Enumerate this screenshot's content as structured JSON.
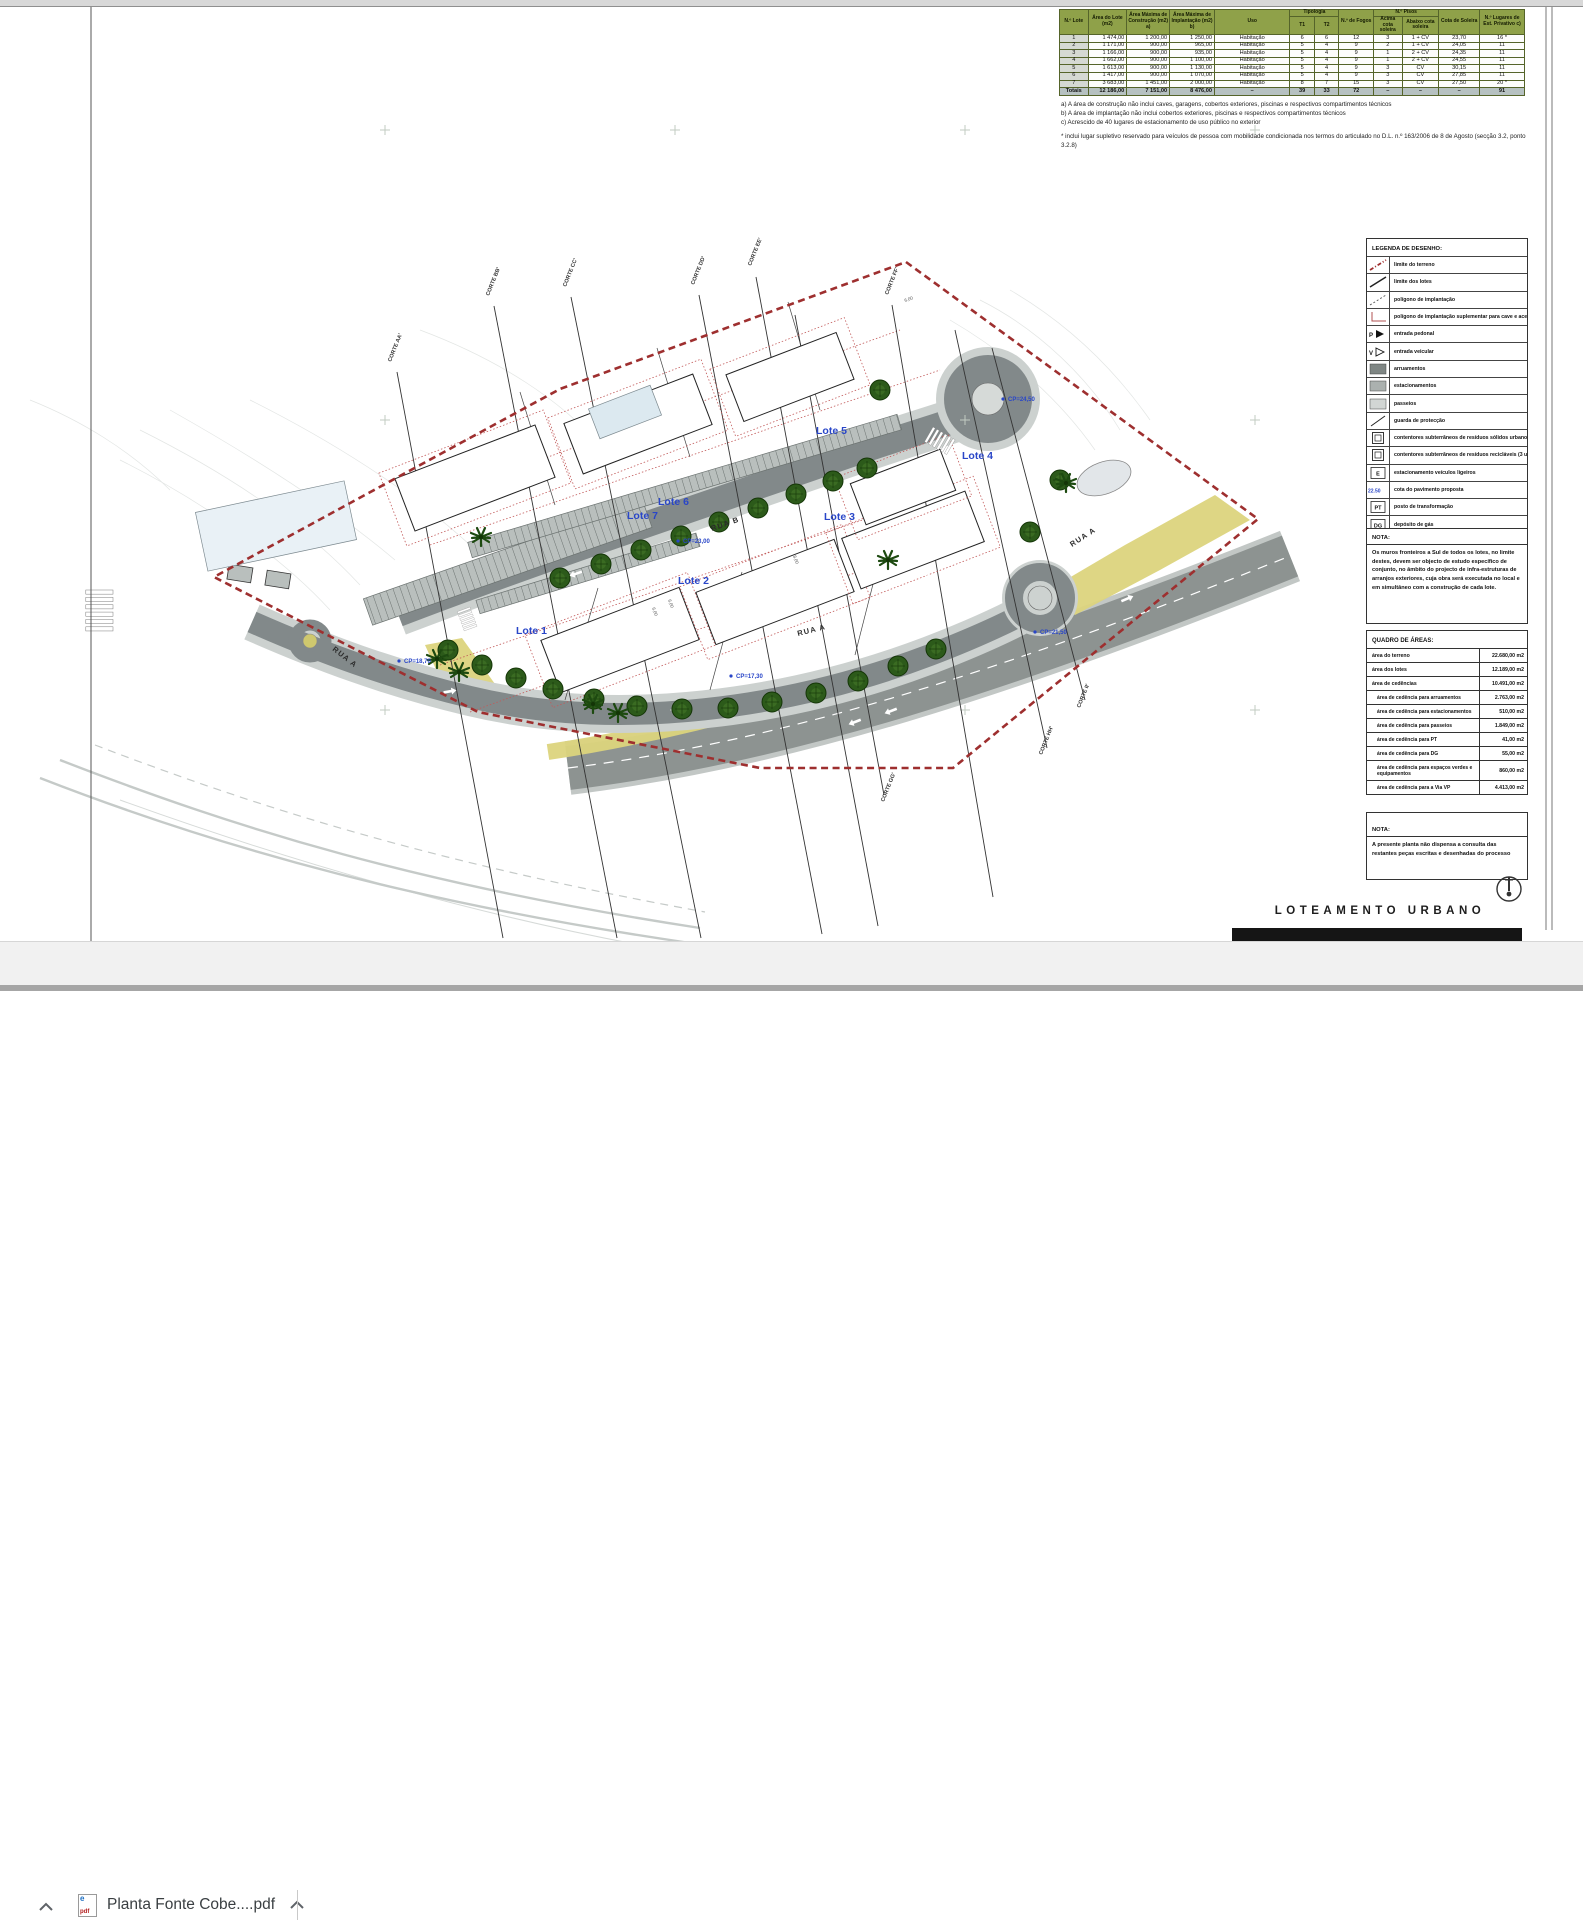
{
  "browser": {
    "download_bar": {
      "file_name": "Planta Fonte Cobe....pdf",
      "file_type": "pdf",
      "file_icon_letter": "e",
      "icons": {
        "hide_bar": "chevron-up",
        "file_menu": "chevron-up"
      }
    }
  },
  "sheet": {
    "table": {
      "headers": {
        "lote": "N.º Lote",
        "area_lote": "Área do Lote (m2)",
        "area_construcao": "Área Máxima de Construção (m2) a)",
        "area_implantacao": "Área Máxima de Implantação (m2) b)",
        "uso": "Uso",
        "tipologia": "Tipologia",
        "t1": "T1",
        "t2": "T2",
        "fogos": "N.º de Fogos",
        "pisos": "N.º Pisos",
        "acima": "Acima cota soleira",
        "abaixo": "Abaixo cota soleira",
        "cota": "Cota de Soleira",
        "lugares": "N.º Lugares de Est. Privativo c)"
      },
      "rows": [
        [
          "1",
          "1 474,00",
          "1 200,00",
          "1 250,00",
          "Habitação",
          "6",
          "6",
          "12",
          "3",
          "1 + CV",
          "23,70",
          "16 *"
        ],
        [
          "2",
          "1 171,00",
          "900,00",
          "965,00",
          "Habitação",
          "5",
          "4",
          "9",
          "2",
          "1 + CV",
          "24,05",
          "11"
        ],
        [
          "3",
          "1 166,00",
          "900,00",
          "935,00",
          "Habitação",
          "5",
          "4",
          "9",
          "1",
          "2 + CV",
          "24,35",
          "11"
        ],
        [
          "4",
          "1 662,00",
          "900,00",
          "1 100,00",
          "Habitação",
          "5",
          "4",
          "9",
          "1",
          "2 + CV",
          "24,55",
          "11"
        ],
        [
          "5",
          "1 613,00",
          "900,00",
          "1 130,00",
          "Habitação",
          "5",
          "4",
          "9",
          "3",
          "CV",
          "30,15",
          "11"
        ],
        [
          "6",
          "1 417,00",
          "900,00",
          "1 070,00",
          "Habitação",
          "5",
          "4",
          "9",
          "3",
          "CV",
          "27,85",
          "11"
        ],
        [
          "7",
          "3 683,00",
          "1 451,00",
          "2 000,00",
          "Habitação",
          "8",
          "7",
          "15",
          "3",
          "CV",
          "27,50",
          "20 *"
        ]
      ],
      "totals": [
        "Totais",
        "12 186,00",
        "7 151,00",
        "8 476,00",
        "–",
        "39",
        "33",
        "72",
        "–",
        "–",
        "–",
        "91"
      ],
      "footnotes": [
        "a) A área de construção não inclui caves, garagens, cobertos exteriores, piscinas e respectivos compartimentos técnicos",
        "b) A área de implantação não inclui cobertos exteriores, piscinas e respectivos compartimentos técnicos",
        "c) Acrescido de 40 lugares de estacionamento de uso público no exterior"
      ],
      "note_asterisk": "* inclui lugar supletivo reservado para veículos de pessoa com mobilidade condicionada nos termos do articulado no D.L. n.º 163/2006 de 8 de Agosto (secção 3.2, ponto 3.2.8)"
    },
    "legend": {
      "title": "LEGENDA DE DESENHO:",
      "items": [
        {
          "icon": "boundary-dashdot",
          "label": "limite do terreno"
        },
        {
          "icon": "lot-line",
          "label": "limite dos lotes"
        },
        {
          "icon": "implantation-dashed",
          "label": "polígono de implantação"
        },
        {
          "icon": "implantation-supplementary",
          "label": "polígono de implantação suplementar para cave e acessos"
        },
        {
          "icon": "pedestrian-arrow",
          "glyph": "P",
          "label": "entrada pedonal"
        },
        {
          "icon": "vehicle-arrow",
          "glyph": "V",
          "label": "entrada veicular"
        },
        {
          "icon": "swatch-dark",
          "label": "arruamentos"
        },
        {
          "icon": "swatch-mid",
          "label": "estacionamentos"
        },
        {
          "icon": "swatch-light",
          "label": "passeios"
        },
        {
          "icon": "guard-line",
          "label": "guarda de protecção"
        },
        {
          "icon": "container-box",
          "glyph": "2",
          "label": "contentores subterrâneos de resíduos sólidos urbanos (2 un.)"
        },
        {
          "icon": "container-box",
          "glyph": "3",
          "label": "contentores subterrâneos de resíduos recicláveis (3 un.)"
        },
        {
          "icon": "letter-box",
          "glyph": "E",
          "label": "estacionamento veículos ligeiros"
        },
        {
          "icon": "blue-level",
          "glyph": "22.50",
          "label": "cota do pavimento proposta"
        },
        {
          "icon": "letter-box",
          "glyph": "PT",
          "label": "posto de transformação"
        },
        {
          "icon": "letter-box",
          "glyph": "DG",
          "label": "depósito de gás"
        }
      ]
    },
    "nota1": {
      "title": "NOTA:",
      "body": "Os muros fronteiros a Sul de todos os lotes, no limite destes, devem ser objecto de estudo específico de conjunto, no âmbito do projecto de infra-estruturas de arranjos exteriores, cuja obra será executada no local e em simultâneo com a construção de cada lote."
    },
    "quadro_areas": {
      "title": "QUADRO DE ÁREAS:",
      "rows": [
        {
          "label": "área do terreno",
          "value": "22.680,00 m2",
          "main": true
        },
        {
          "label": "área dos lotes",
          "value": "12.189,00 m2",
          "main": true
        },
        {
          "label": "área de cedências",
          "value": "10.491,00 m2",
          "main": true
        },
        {
          "label": "área de cedência para arruamentos",
          "value": "2.763,00 m2",
          "main": false
        },
        {
          "label": "área de cedência para estacionamentos",
          "value": "510,00 m2",
          "main": false
        },
        {
          "label": "área de cedência para passeios",
          "value": "1.849,00 m2",
          "main": false
        },
        {
          "label": "área de cedência para PT",
          "value": "41,00 m2",
          "main": false
        },
        {
          "label": "área de cedência para DG",
          "value": "55,00 m2",
          "main": false
        },
        {
          "label": "área de cedência para espaços verdes e equipamentos",
          "value": "860,00 m2",
          "main": false
        },
        {
          "label": "área de cedência para a Via VP",
          "value": "4.413,00 m2",
          "main": false
        }
      ]
    },
    "nota2": {
      "title": "NOTA:",
      "body": "A presente planta não dispensa a consulta das restantes peças escritas e desenhadas do processo"
    },
    "title_block": {
      "title": "LOTEAMENTO URBANO"
    },
    "plan": {
      "lot_labels": [
        {
          "text": "Lote 1",
          "x": 516,
          "y": 634
        },
        {
          "text": "Lote 2",
          "x": 678,
          "y": 584
        },
        {
          "text": "Lote 3",
          "x": 824,
          "y": 520
        },
        {
          "text": "Lote 4",
          "x": 962,
          "y": 459
        },
        {
          "text": "Lote 5",
          "x": 816,
          "y": 434
        },
        {
          "text": "Lote 6",
          "x": 658,
          "y": 505
        },
        {
          "text": "Lote 7",
          "x": 627,
          "y": 519
        }
      ],
      "street_labels": [
        {
          "text": "RUA A",
          "x": 332,
          "y": 650,
          "rot": 38
        },
        {
          "text": "RUA A",
          "x": 798,
          "y": 636,
          "rot": -14
        },
        {
          "text": "RUA B",
          "x": 712,
          "y": 531,
          "rot": -19
        },
        {
          "text": "RUA A",
          "x": 1072,
          "y": 547,
          "rot": -33
        }
      ],
      "cp_labels": [
        {
          "text": "CP=24,50",
          "x": 1008,
          "y": 401
        },
        {
          "text": "CP=23,00",
          "x": 683,
          "y": 543
        },
        {
          "text": "CP=18,70",
          "x": 404,
          "y": 663
        },
        {
          "text": "CP=17,30",
          "x": 736,
          "y": 678
        },
        {
          "text": "CP=21,50",
          "x": 1040,
          "y": 634
        }
      ],
      "corte_labels": [
        {
          "text": "CORTE AA'",
          "x": 391,
          "y": 362,
          "rot": -68
        },
        {
          "text": "CORTE BB'",
          "x": 489,
          "y": 296,
          "rot": -68
        },
        {
          "text": "CORTE CC'",
          "x": 566,
          "y": 287,
          "rot": -68
        },
        {
          "text": "CORTE DD'",
          "x": 694,
          "y": 285,
          "rot": -68
        },
        {
          "text": "CORTE EE'",
          "x": 751,
          "y": 266,
          "rot": -68
        },
        {
          "text": "CORTE FF'",
          "x": 888,
          "y": 295,
          "rot": -68
        },
        {
          "text": "CORTE GG'",
          "x": 884,
          "y": 802,
          "rot": -68
        },
        {
          "text": "CORTE HH'",
          "x": 1042,
          "y": 755,
          "rot": -68
        },
        {
          "text": "CORTE II'",
          "x": 1080,
          "y": 708,
          "rot": -68
        }
      ],
      "dim_labels": [
        {
          "text": "6,00",
          "x": 652,
          "y": 608,
          "rot": 70
        },
        {
          "text": "6,00",
          "x": 668,
          "y": 600,
          "rot": 70
        },
        {
          "text": "8,00",
          "x": 793,
          "y": 556,
          "rot": 70
        },
        {
          "text": "6,00",
          "x": 905,
          "y": 302,
          "rot": -20
        }
      ]
    }
  },
  "colors": {
    "table_header_green": "#8fa149",
    "totals_gray": "#b6c1c1",
    "boundary_red": "#9e2f2f",
    "label_blue": "#2946c8",
    "road_dark": "#82898a",
    "parking_gray": "#b9bfbd",
    "sidewalk_gray": "#ccd1cf",
    "landscape_yellow": "#dcd47d",
    "tree_green": "#234d12",
    "black_bar": "#151515"
  }
}
